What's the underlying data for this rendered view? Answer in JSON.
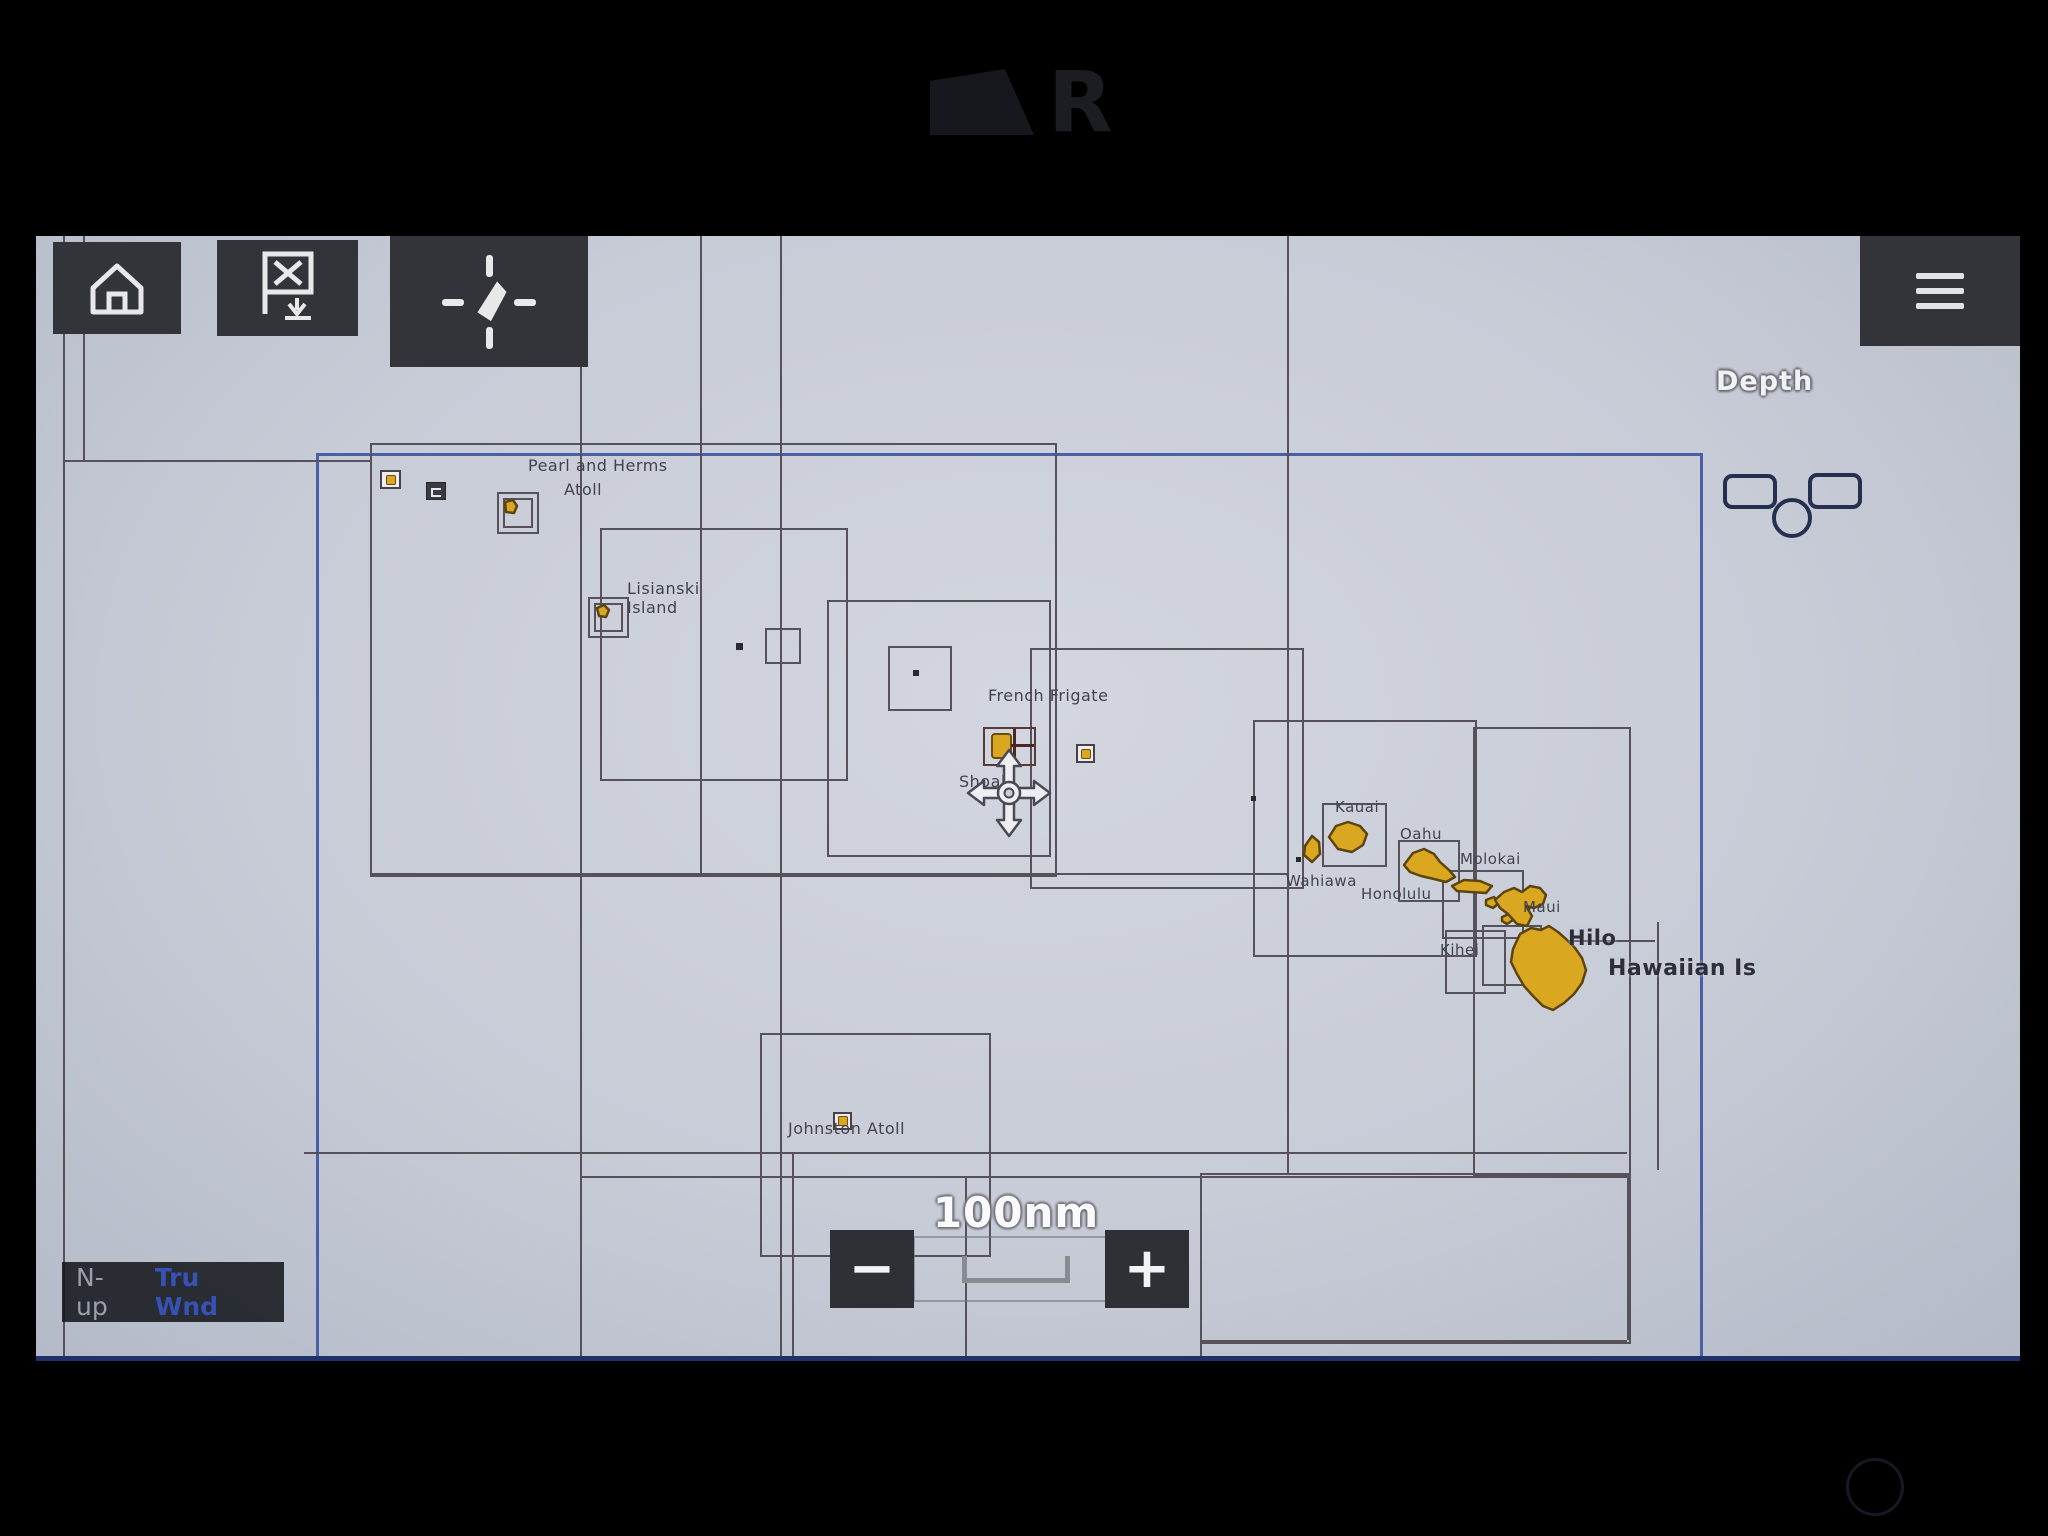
{
  "device": {
    "brand_mark": "R"
  },
  "toolbar": {
    "icons": [
      "home-icon",
      "waypoint-flag-icon",
      "find-ship-icon",
      "menu-icon"
    ]
  },
  "data_overlay": {
    "depth_label": "Depth"
  },
  "chart": {
    "place_labels": [
      {
        "id": "pearl-herms-1",
        "text": "Pearl and Herms",
        "x": 492,
        "y": 220,
        "size": 16
      },
      {
        "id": "pearl-herms-2",
        "text": "Atoll",
        "x": 528,
        "y": 244,
        "size": 16
      },
      {
        "id": "lisianski-1",
        "text": "Lisianski",
        "x": 591,
        "y": 343,
        "size": 16
      },
      {
        "id": "lisianski-2",
        "text": "Island",
        "x": 591,
        "y": 362,
        "size": 16
      },
      {
        "id": "french-frigate",
        "text": "French Frigate",
        "x": 952,
        "y": 450,
        "size": 16
      },
      {
        "id": "shoals",
        "text": "Shoals",
        "x": 923,
        "y": 536,
        "size": 16
      },
      {
        "id": "kauai",
        "text": "Kauai",
        "x": 1299,
        "y": 562,
        "size": 15
      },
      {
        "id": "oahu",
        "text": "Oahu",
        "x": 1364,
        "y": 589,
        "size": 15
      },
      {
        "id": "wahiawa",
        "text": "Wahiawa",
        "x": 1250,
        "y": 636,
        "size": 15
      },
      {
        "id": "honolulu",
        "text": "Honolulu",
        "x": 1325,
        "y": 649,
        "size": 15
      },
      {
        "id": "molokai",
        "text": "Molokai",
        "x": 1424,
        "y": 614,
        "size": 15
      },
      {
        "id": "maui",
        "text": "Maui",
        "x": 1487,
        "y": 662,
        "size": 15
      },
      {
        "id": "kihei",
        "text": "Kihei",
        "x": 1404,
        "y": 705,
        "size": 15
      },
      {
        "id": "hilo",
        "text": "Hilo",
        "x": 1532,
        "y": 690,
        "size": 21,
        "bold": true
      },
      {
        "id": "hawaiian-is",
        "text": "Hawaiian Is",
        "x": 1572,
        "y": 720,
        "size": 22,
        "bold": true
      },
      {
        "id": "johnston-atoll",
        "text": "Johnston Atoll",
        "x": 752,
        "y": 883,
        "size": 16
      }
    ],
    "islands": [
      "Niihau",
      "Kauai",
      "Oahu",
      "Molokai",
      "Lanai",
      "Kahoolawe",
      "Maui",
      "Hawaii"
    ],
    "scale": {
      "range_label": "100nm"
    },
    "zoom": {
      "out_label": "−",
      "in_label": "+"
    },
    "status_bar": {
      "orientation": "N-up",
      "wind": "Tru Wnd"
    },
    "colors": {
      "island_fill": "#d9a820",
      "island_stroke": "#5c440e",
      "chart_line": "#57515c",
      "boundary_blue": "#4a5fa8",
      "chart_background": "#c9cdd7",
      "button_background": "#32343a",
      "wind_text_blue": "#3552b4"
    }
  }
}
